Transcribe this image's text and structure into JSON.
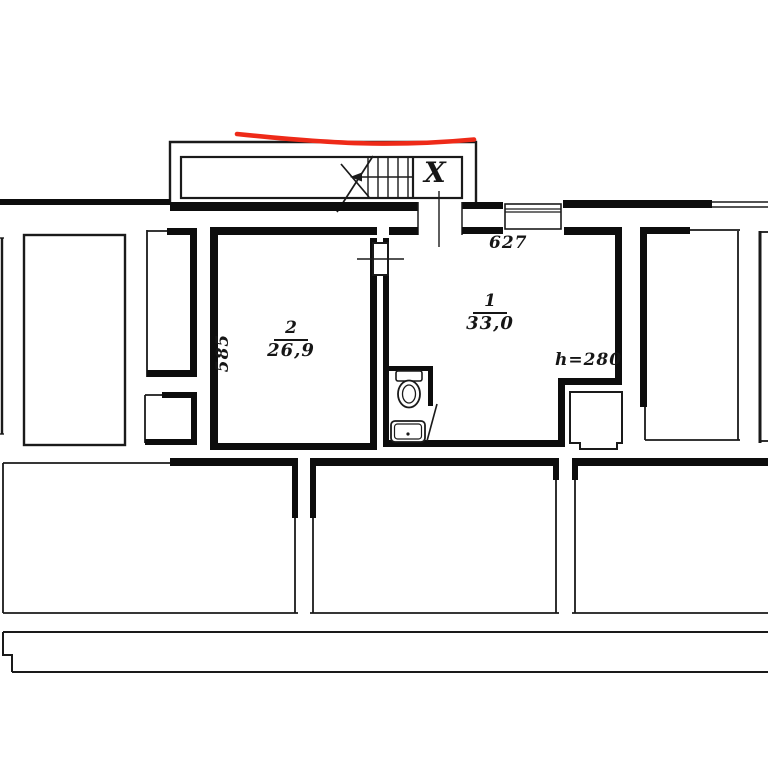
{
  "document": {
    "type": "apartment floor plan (scan)",
    "stairwell_label": "X",
    "apartment_number": "627",
    "ceiling_height_note": "h=280",
    "wall_dimension": "585"
  },
  "rooms": [
    {
      "number": "2",
      "area": "26,9"
    },
    {
      "number": "1",
      "area": "33,0"
    }
  ],
  "fixtures": [
    "toilet",
    "sink"
  ],
  "colors": {
    "line": "#1a1a1a",
    "wall": "#0d0d0d",
    "annotation_red": "#ee2a18",
    "background": "#ffffff"
  }
}
